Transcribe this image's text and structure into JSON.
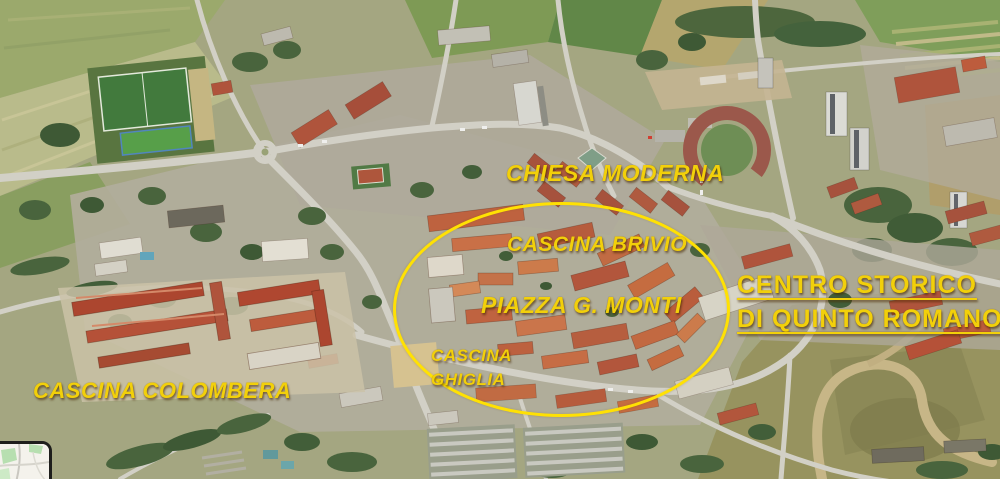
{
  "map": {
    "kind": "annotated-aerial-photograph",
    "annotations": {
      "chiesa_moderna": {
        "text": "CHIESA MODERNA"
      },
      "cascina_brivio": {
        "text": "CASCINA BRIVIO"
      },
      "piazza_monti": {
        "text": "PIAZZA G. MONTI"
      },
      "cascina_ghiglia": {
        "line1": "CASCINA",
        "line2": "GHIGLIA"
      },
      "cascina_colombera": {
        "text": "CASCINA COLOMBERA"
      },
      "centro_storico": {
        "line1": "CENTRO STORICO",
        "line2": "DI QUINTO ROMANO"
      }
    },
    "highlight": {
      "shape": "ellipse"
    }
  },
  "colors": {
    "annotation_yellow": "#F2D00A",
    "ellipse_yellow": "#FFE103"
  }
}
